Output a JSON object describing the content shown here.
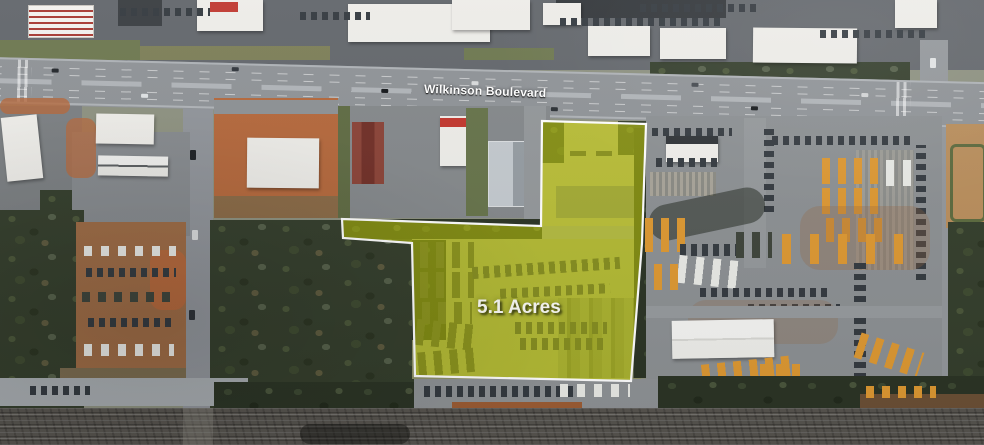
{
  "labels": {
    "road": "Wilkinson Boulevard",
    "acreage": "5.1 Acres"
  },
  "parcel": {
    "points": "542,121 646,124 642,243 631,381 415,376 412,243 343,238 342,219 541,226",
    "fill": "#d6df00",
    "fill_opacity": "0.5",
    "stroke": "#ffffff",
    "stroke_width": "2.2"
  },
  "palette": {
    "bus_yellow": "#dd9832",
    "asphalt": "#8c9093",
    "woods": "#343e2c",
    "dirt": "#b4683c",
    "railroad": "#57544f",
    "label_text": "#ffffff"
  }
}
